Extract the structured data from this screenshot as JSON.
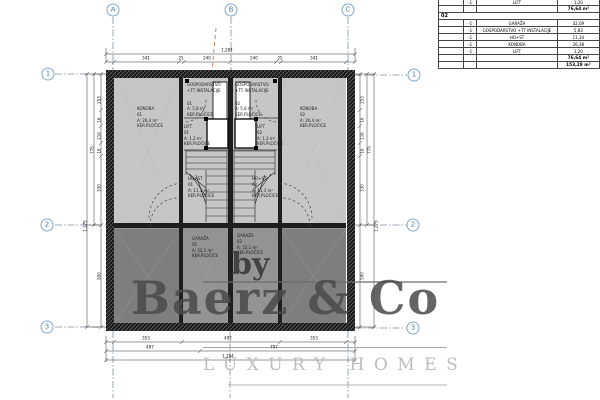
{
  "watermark": {
    "by": "by",
    "brand": "Baerz & Co",
    "tagline": "LUXURY HOMES"
  },
  "grid": {
    "cols": [
      "A",
      "B",
      "C"
    ],
    "rows": [
      "1",
      "2",
      "3"
    ]
  },
  "dims": {
    "top_total": "1,284",
    "top_segments": [
      "341",
      "25",
      "240",
      "240",
      "25",
      "341"
    ],
    "bottom_row1": [
      "353",
      "492",
      "353"
    ],
    "bottom_row2": [
      "487",
      "797"
    ],
    "bottom_total": "1,284",
    "side_segments": [
      "253",
      "16",
      "116",
      "16",
      "330",
      "500"
    ],
    "side_subtotal": "775",
    "side_total": "1,275"
  },
  "rooms": [
    {
      "name": "KONOBA",
      "num": "01",
      "area": "A: 26,4 m²",
      "finish": "KER.PLOČICE"
    },
    {
      "name": "KONOBA",
      "num": "02",
      "area": "A: 26,4 m²",
      "finish": "KER.PLOČICE"
    },
    {
      "name": "GOSPODARSTVO",
      "name2": "+TT INSTALACIJE",
      "num": "01",
      "area": "A: 5,8 m²",
      "finish": "KER.PLOČICE"
    },
    {
      "name": "GOSPODARSTVO",
      "name2": "+TT INSTALACIJE",
      "num": "02",
      "area": "A: 5,8 m²",
      "finish": "KER.PLOČICE"
    },
    {
      "name": "LIFT",
      "num": "01",
      "area": "A: 1,2 m²",
      "finish": "KER.PLOČICE"
    },
    {
      "name": "LIFT",
      "num": "02",
      "area": "A: 1,2 m²",
      "finish": "KER.PLOČICE"
    },
    {
      "name": "HO+ST",
      "num": "01",
      "area": "A: 11,3 m²",
      "finish": "KER.PLOČICE"
    },
    {
      "name": "HO+ST",
      "num": "02",
      "area": "A: 11,3 m²",
      "finish": "KER.PLOČICE"
    },
    {
      "name": "GARAŽA",
      "num": "01",
      "area": "A: 32,1 m²",
      "finish": "KER.PLOČICE"
    },
    {
      "name": "GARAŽA",
      "num": "02",
      "area": "A: 32,1 m²",
      "finish": "KER.PLOČICE"
    }
  ],
  "table": {
    "top_row": {
      "qty": "-1",
      "name": "LIFT",
      "value": "1,20"
    },
    "subtotal_top": "76,64 m²",
    "section": "02",
    "rows": [
      {
        "qty": "-1",
        "name": "GARAŽA",
        "value": "32,09"
      },
      {
        "qty": "-1",
        "name": "GOSPODARSTVO +TT INSTALACIJE",
        "value": "5,83"
      },
      {
        "qty": "-1",
        "name": "HO+ST",
        "value": "11,34"
      },
      {
        "qty": "-1",
        "name": "KONOBA",
        "value": "26,38"
      },
      {
        "qty": "-1",
        "name": "LIFT",
        "value": "1,20"
      }
    ],
    "subtotal": "76,64 m²",
    "total": "153,28 m²"
  },
  "colors": {
    "grid_accent": "#7fa8c9",
    "wall": "#1a1a1a",
    "floor_upper": "#c6c6c6",
    "floor_garage": "#939393",
    "floor_side_rooms": "#7e7e7e",
    "watermark_gray": "#4a4a4a",
    "revision_orange": "#c4784a"
  }
}
